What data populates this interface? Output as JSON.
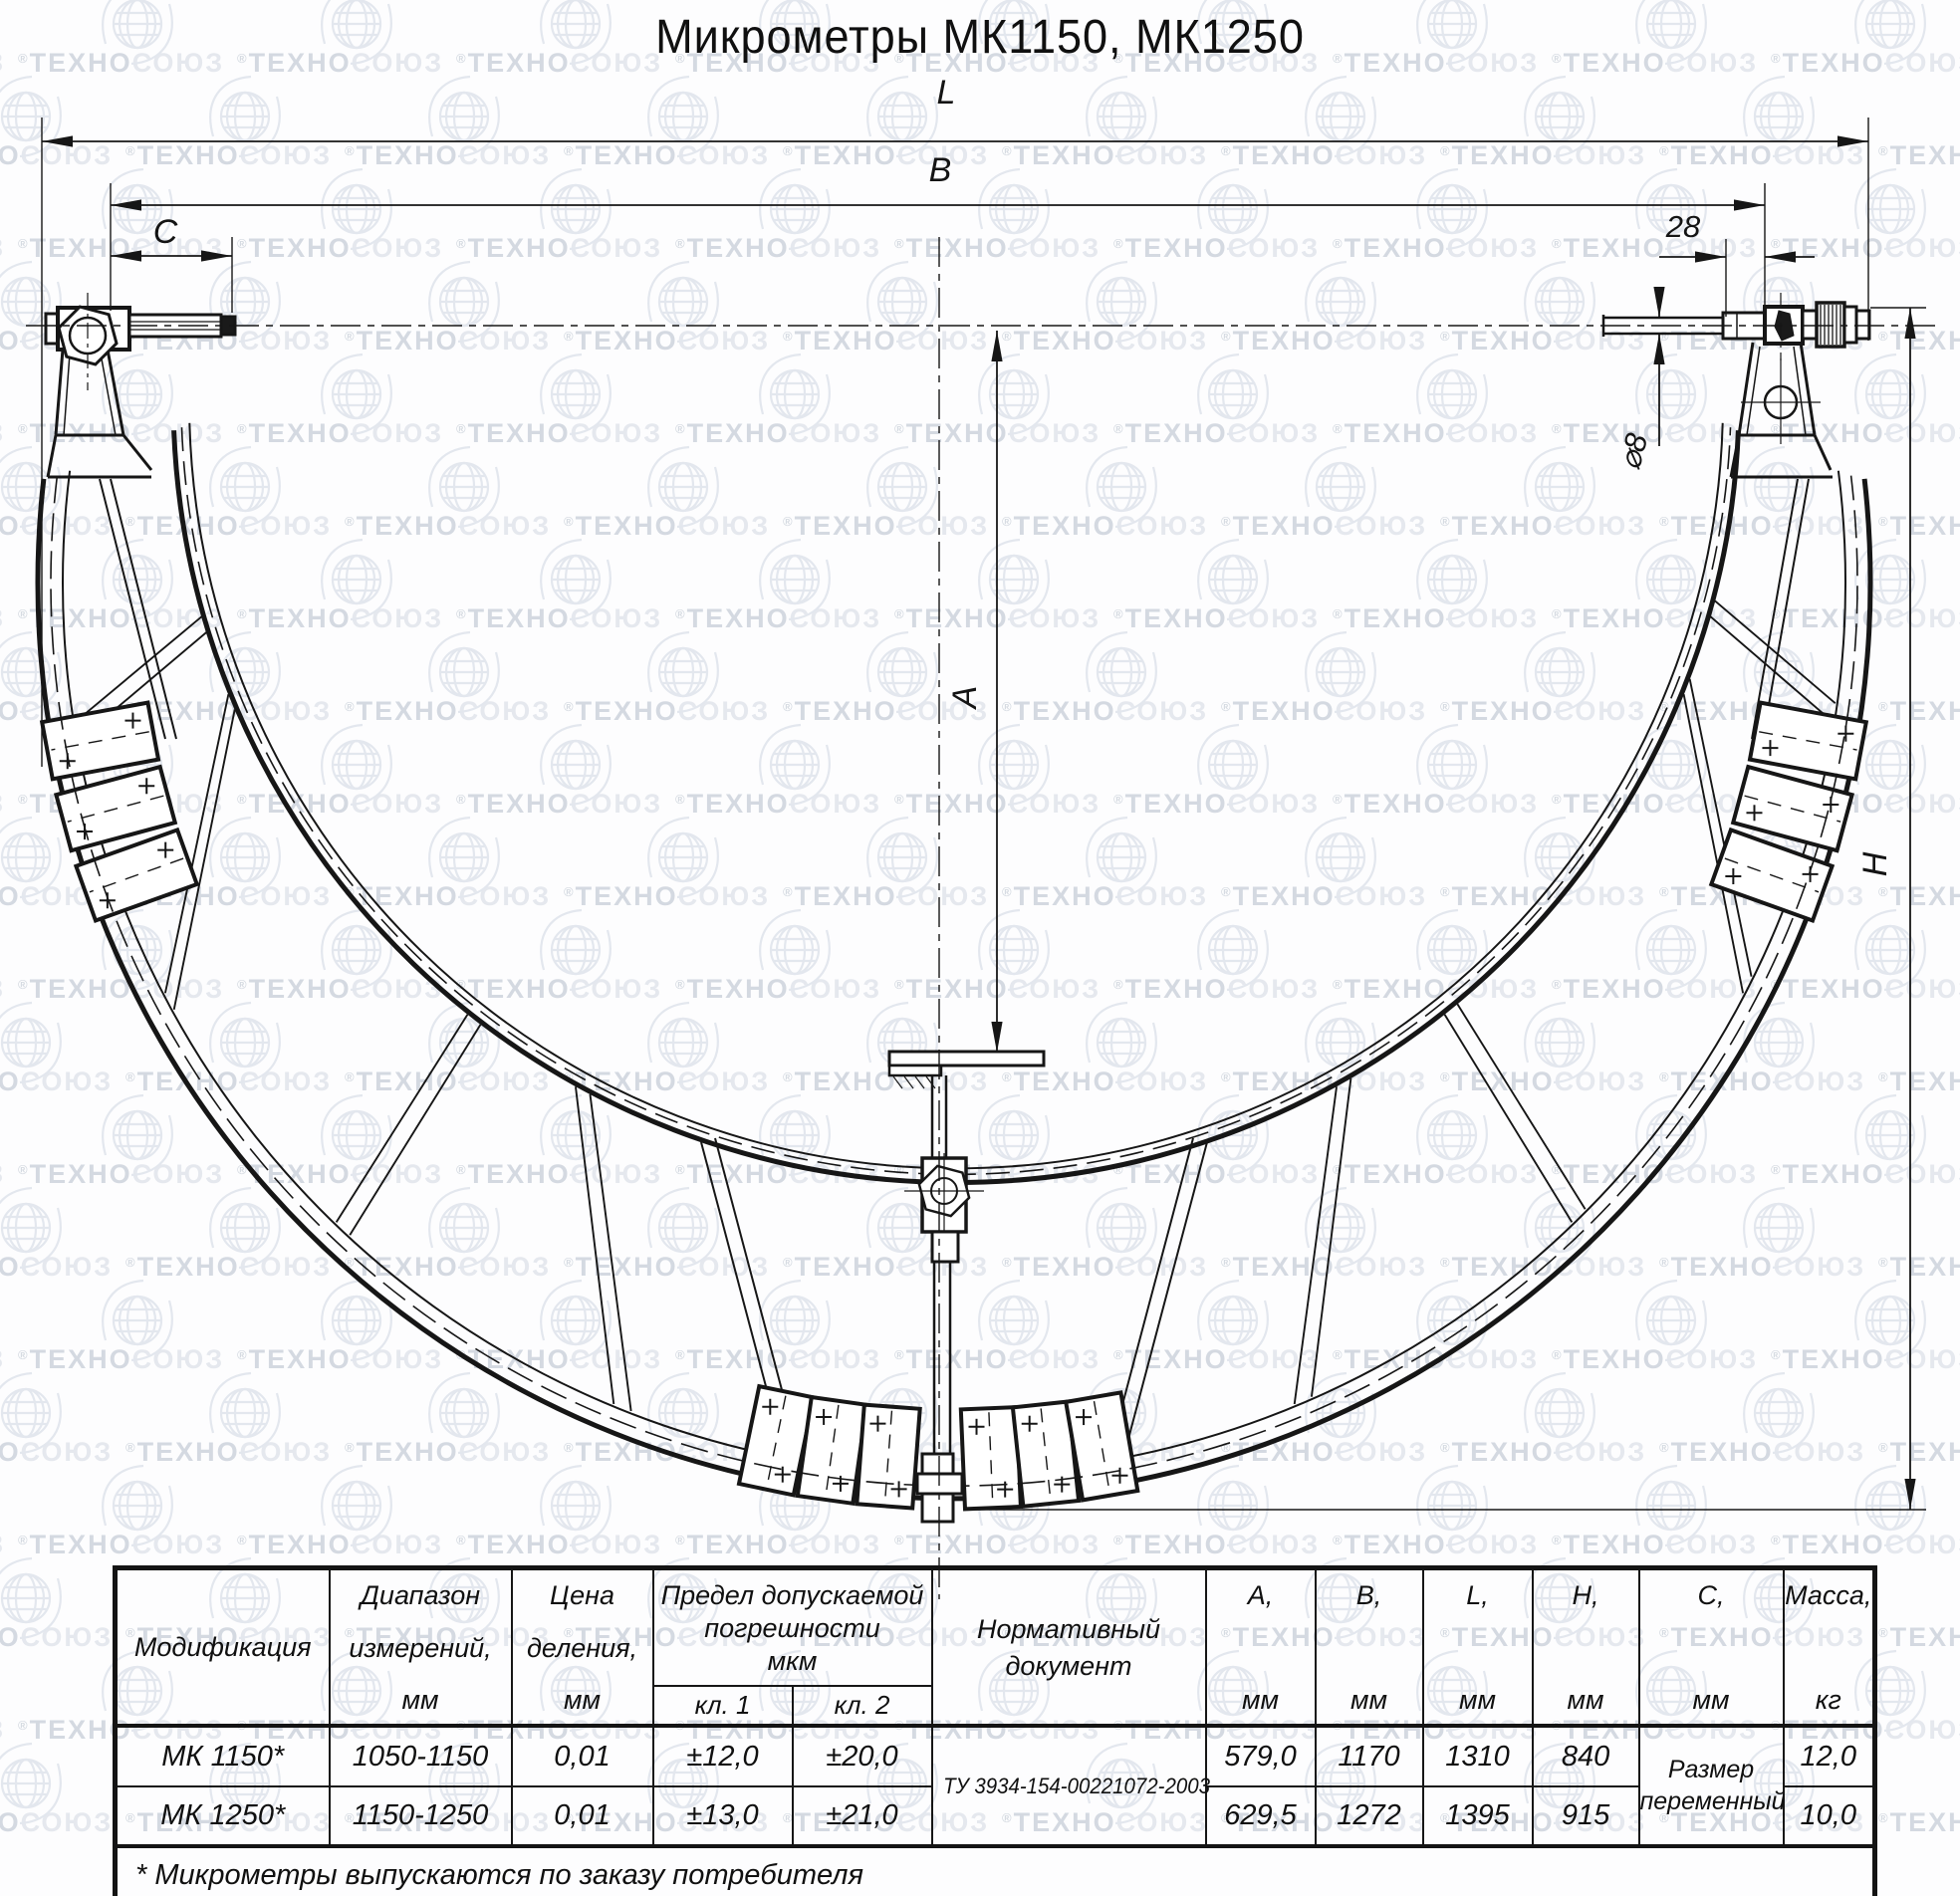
{
  "title": "Микрометры МК1150, МК1250",
  "watermark": {
    "text_dark": "ТЕХНО",
    "text_light": "СОЮЗ",
    "reg": "®"
  },
  "dims": {
    "l": "L",
    "b": "B",
    "c": "C",
    "len28": "28",
    "dia8": "⌀8",
    "a": "A",
    "h": "H"
  },
  "table": {
    "headers": {
      "modification": "Модификация",
      "range": [
        "Диапазон",
        "измерений,",
        "мм"
      ],
      "division": [
        "Цена",
        "деления,",
        "мм"
      ],
      "error": [
        "Предел допускаемой",
        "погрешности",
        "мкм"
      ],
      "class1": "кл. 1",
      "class2": "кл. 2",
      "normative": [
        "Нормативный",
        "документ"
      ],
      "a": [
        "А,",
        "мм"
      ],
      "b": [
        "В,",
        "мм"
      ],
      "l": [
        "L,",
        "мм"
      ],
      "h": [
        "Н,",
        "мм"
      ],
      "c": [
        "С,",
        "мм"
      ],
      "mass": [
        "Масса,",
        "кг"
      ]
    },
    "rows": [
      {
        "mod": "МК 1150*",
        "range": "1050-1150",
        "division": "0,01",
        "class1": "±12,0",
        "class2": "±20,0",
        "a": "579,0",
        "b": "1170",
        "l": "1310",
        "h": "840",
        "mass": "12,0"
      },
      {
        "mod": "МК 1250*",
        "range": "1150-1250",
        "division": "0,01",
        "class1": "±13,0",
        "class2": "±21,0",
        "a": "629,5",
        "b": "1272",
        "l": "1395",
        "h": "915",
        "mass": "10,0"
      }
    ],
    "normative_value": "ТУ 3934-154-00221072-2003",
    "c_value": [
      "Размер",
      "переменный"
    ],
    "footnote": "* Микрометры выпускаются по заказу потребителя"
  }
}
